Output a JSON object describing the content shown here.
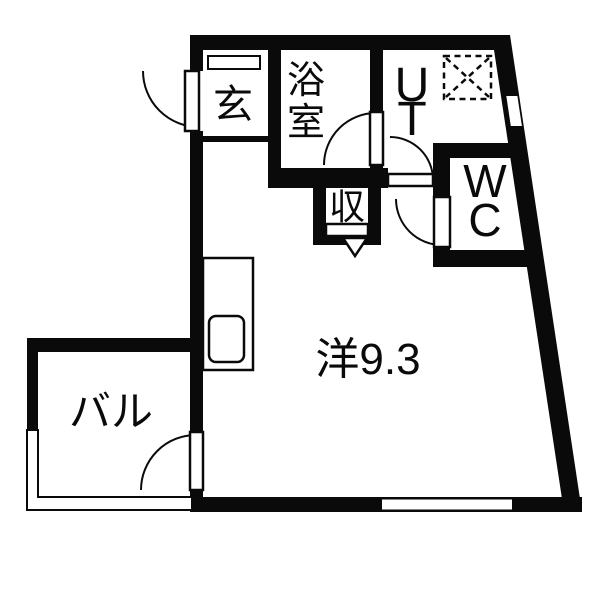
{
  "floorplan": {
    "rooms": {
      "entrance": {
        "label": "玄"
      },
      "bathroom": {
        "label": "浴室",
        "chars": [
          "浴",
          "室"
        ]
      },
      "utility": {
        "label": "UT",
        "chars": [
          "U",
          "T"
        ]
      },
      "toilet": {
        "label": "WC",
        "chars": [
          "W",
          "C"
        ]
      },
      "closet": {
        "label": "収"
      },
      "western_room": {
        "label": "洋9.3",
        "area_value": "9.3"
      },
      "balcony": {
        "label": "バル"
      }
    },
    "colors": {
      "wall": "#0a0a0a",
      "floor": "#ffffff"
    }
  }
}
